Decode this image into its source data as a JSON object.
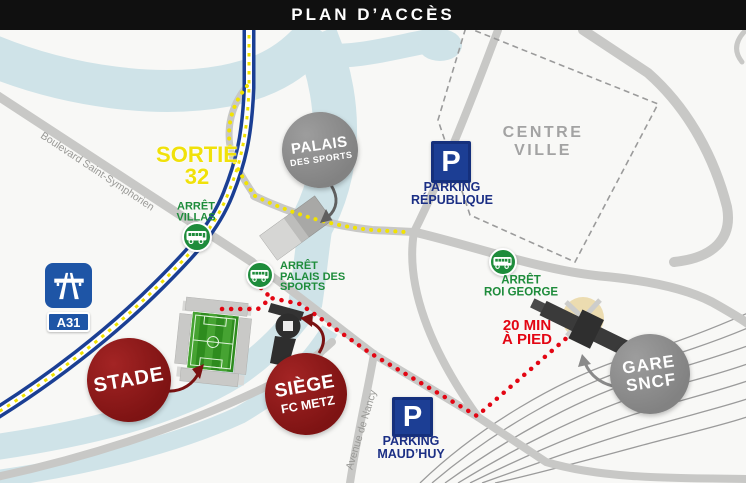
{
  "header": {
    "title": "PLAN D’ACCÈS"
  },
  "map": {
    "sortie": {
      "line1": "SORTIE",
      "line2": "32"
    },
    "signs": {
      "a31": "A31"
    },
    "streets": {
      "boulevard": "Boulevard Saint-Symphorien",
      "avenue": "Avenue de Nancy"
    },
    "bus_stops": {
      "villas": {
        "line1": "ARRÊT",
        "line2": "VILLAS"
      },
      "palais": {
        "line1": "ARRÊT",
        "line2": "PALAIS DES",
        "line3": "SPORTS"
      },
      "roi_george": {
        "line1": "ARRÊT",
        "line2": "ROI GEORGE"
      }
    },
    "parkings": {
      "republique": {
        "symbol": "P",
        "line1": "PARKING",
        "line2": "RÉPUBLIQUE"
      },
      "maudhuy": {
        "symbol": "P",
        "line1": "PARKING",
        "line2": "MAUD’HUY"
      }
    },
    "places": {
      "palais": {
        "line1": "PALAIS",
        "line2": "DES SPORTS"
      },
      "centre_ville": {
        "line1": "CENTRE",
        "line2": "VILLE"
      },
      "stade": {
        "label": "STADE"
      },
      "siege": {
        "line1": "SIÈGE",
        "line2": "FC METZ"
      },
      "gare": {
        "line1": "GARE",
        "line2": "SNCF"
      }
    },
    "walk": {
      "line1": "20 MIN",
      "line2": "À PIED"
    }
  },
  "colors": {
    "title_bg": "#101010",
    "route_walk_red": "#e30613",
    "landmark_dark_red": "#8a1a1a",
    "bus_green": "#1e8c3b",
    "parking_navy": "#1b2f85",
    "motorway_blue": "#1b3f94",
    "sign_blue": "#1e55a6",
    "route_bus_yellow": "#f2e300",
    "river": "#cfe3e8",
    "road_gray": "#c8c8c6",
    "circle_gray": "#8d8d8d",
    "station_dark": "#383838",
    "square_beige": "#ecdcb0"
  }
}
